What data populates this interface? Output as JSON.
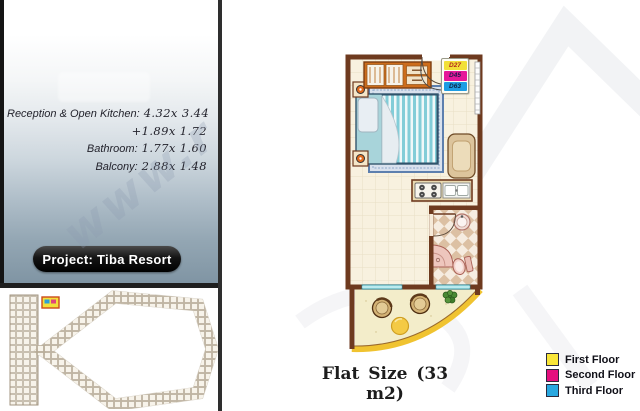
{
  "left_panel": {
    "dimensions": [
      {
        "label": "Reception & Open Kitchen:",
        "value": "4.32x 3.44"
      },
      {
        "label": "",
        "value": "+1.89x 1.72"
      },
      {
        "label": "Bathroom:",
        "value": "1.77x 1.60"
      },
      {
        "label": "Balcony:",
        "value": "2.88x 1.48"
      }
    ],
    "project_label": "Project: Tiba Resort"
  },
  "floor_plan": {
    "unit_tags": [
      {
        "code": "D27",
        "bg": "#f2e038"
      },
      {
        "code": "D45",
        "bg": "#e5179a"
      },
      {
        "code": "D63",
        "bg": "#1e9de3"
      }
    ]
  },
  "footer": {
    "flat_size": "Flat Size (33 m2)"
  },
  "legend": {
    "items": [
      {
        "label": "First Floor",
        "color": "#f8e538"
      },
      {
        "label": "Second Floor",
        "color": "#e50f7e"
      },
      {
        "label": "Third Floor",
        "color": "#29a8e0"
      }
    ]
  },
  "watermark": {
    "text": "www.r"
  }
}
